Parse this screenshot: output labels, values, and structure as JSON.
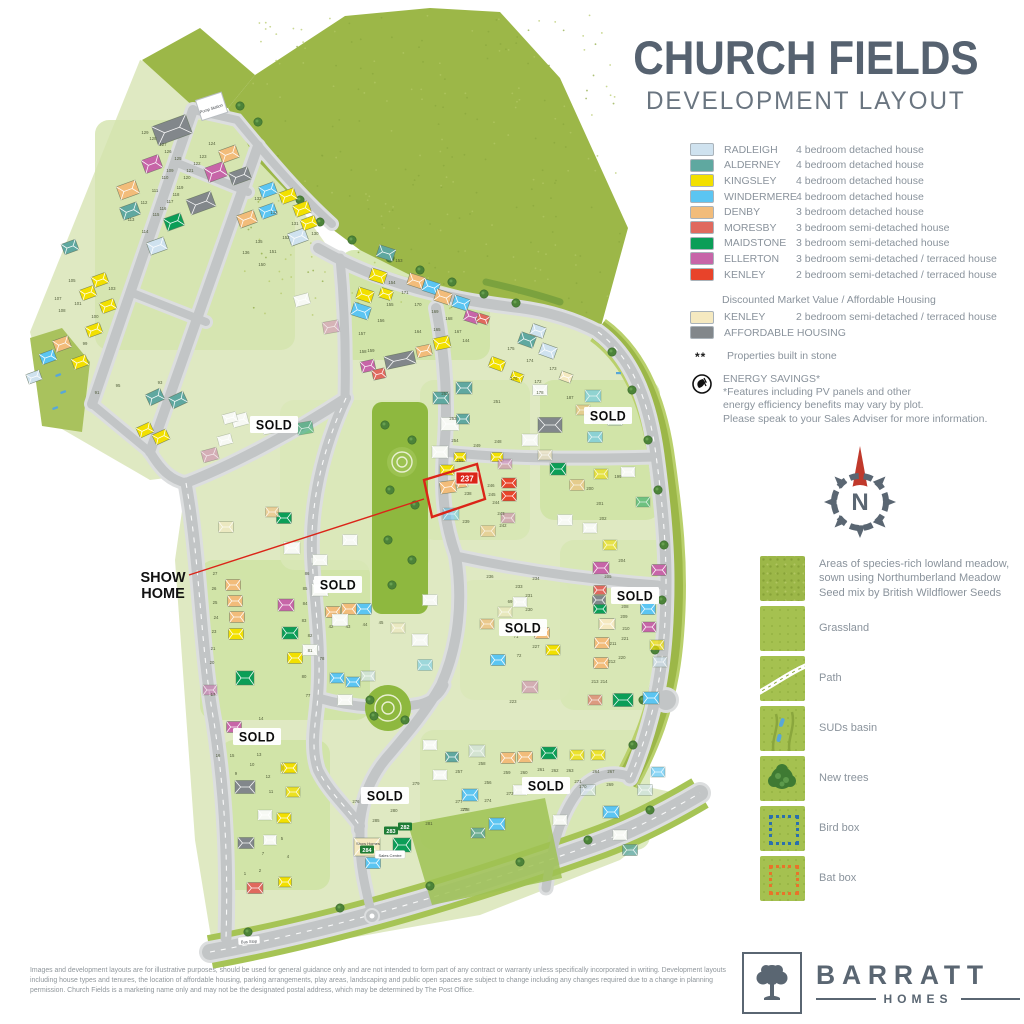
{
  "title": "CHURCH FIELDS",
  "subtitle": "DEVELOPMENT LAYOUT",
  "colors": {
    "rad": "#cfe2ef",
    "ald": "#5fa8a0",
    "kin": "#f2e000",
    "win": "#5bc5f2",
    "den": "#f2bc7a",
    "mor": "#e0695e",
    "mai": "#0b9e57",
    "ell": "#c765a8",
    "ken": "#e8432a",
    "dmv": "#f5e9c0",
    "aff": "#82878b",
    "wsh": "#f7f9f4",
    "red_accent": "#db2418",
    "title_gray": "#566270",
    "meadow": "#9cb748",
    "grass": "#a5c150",
    "site": "#dfe9c2",
    "road": "#c2c5c6"
  },
  "legend": {
    "house_types": [
      {
        "name": "RADLEIGH",
        "desc": "4 bedroom detached house",
        "color": "#cfe2ef"
      },
      {
        "name": "ALDERNEY",
        "desc": "4 bedroom detached house",
        "color": "#5fa8a0"
      },
      {
        "name": "KINGSLEY",
        "desc": "4 bedroom detached house",
        "color": "#f2e000"
      },
      {
        "name": "WINDERMERE",
        "desc": "4 bedroom detached house",
        "color": "#5bc5f2"
      },
      {
        "name": "DENBY",
        "desc": "3 bedroom detached house",
        "color": "#f2bc7a"
      },
      {
        "name": "MORESBY",
        "desc": "3 bedroom semi-detached house",
        "color": "#e0695e"
      },
      {
        "name": "MAIDSTONE",
        "desc": "3 bedroom semi-detached house",
        "color": "#0b9e57"
      },
      {
        "name": "ELLERTON",
        "desc": "3 bedroom semi-detached / terraced house",
        "color": "#c765a8"
      },
      {
        "name": "KENLEY",
        "desc": "2 bedroom semi-detached / terraced house",
        "color": "#e8432a"
      }
    ],
    "dmv_heading": "Discounted Market Value / Affordable Housing",
    "dmv_items": [
      {
        "name": "KENLEY",
        "desc": "2 bedroom semi-detached / terraced house",
        "color": "#f5e9c0"
      },
      {
        "name": "AFFORDABLE HOUSING",
        "desc": "",
        "color": "#82878b"
      }
    ],
    "stone_marker": "**",
    "stone_note": "Properties built in stone",
    "energy_title": "ENERGY SAVINGS*",
    "energy_note_1": "*Features including PV panels and other",
    "energy_note_2": "energy efficiency benefits may vary by plot.",
    "energy_note_3": "Please speak to your Sales Adviser for more information."
  },
  "features": [
    {
      "label": "Areas of species-rich lowland meadow, sown using Northumberland Meadow Seed mix by British Wildflower Seeds",
      "swatch": "meadow"
    },
    {
      "label": "Grassland",
      "swatch": "grassland"
    },
    {
      "label": "Path",
      "swatch": "path"
    },
    {
      "label": "SUDs basin",
      "swatch": "suds"
    },
    {
      "label": "New trees",
      "swatch": "trees"
    },
    {
      "label": "Bird box",
      "swatch": "birdbox"
    },
    {
      "label": "Bat box",
      "swatch": "batbox"
    }
  ],
  "compass": {
    "label": "N"
  },
  "map": {
    "sold_label": "SOLD",
    "sold_positions": [
      [
        274,
        425
      ],
      [
        608,
        416
      ],
      [
        338,
        585
      ],
      [
        635,
        596
      ],
      [
        523,
        628
      ],
      [
        257,
        737
      ],
      [
        385,
        796
      ],
      [
        546,
        786
      ]
    ],
    "show_home": {
      "line1": "SHOW",
      "line2": "HOME",
      "x": 163,
      "y": 578,
      "leader": [
        [
          189,
          575
        ],
        [
          424,
          499
        ]
      ],
      "outline": "424,480 477,464 485,499 432,517",
      "tag": {
        "text": "237",
        "x": 467,
        "y": 478
      }
    },
    "labels": [
      {
        "text": "Pump Station",
        "kind": "plain",
        "x": 211,
        "y": 108,
        "rot": -18
      },
      {
        "text": "Bus Stop",
        "kind": "pill",
        "x": 249,
        "y": 941,
        "rot": -4
      },
      {
        "text": "Show Homes",
        "kind": "plain",
        "x": 368,
        "y": 843,
        "rot": 0
      },
      {
        "text": "Sales Centre",
        "kind": "pill",
        "x": 390,
        "y": 855,
        "rot": 0
      },
      {
        "text": "282",
        "kind": "green",
        "x": 405,
        "y": 827,
        "rot": 0
      },
      {
        "text": "283",
        "kind": "green",
        "x": 391,
        "y": 831,
        "rot": 0
      },
      {
        "text": "284",
        "kind": "green",
        "x": 367,
        "y": 850,
        "rot": 0
      }
    ],
    "plot_numbers": [
      {
        "n": "129",
        "x": 145,
        "y": 134
      },
      {
        "n": "128",
        "x": 153,
        "y": 140
      },
      {
        "n": "127",
        "x": 163,
        "y": 146
      },
      {
        "n": "126",
        "x": 168,
        "y": 153
      },
      {
        "n": "125",
        "x": 178,
        "y": 160
      },
      {
        "n": "124",
        "x": 212,
        "y": 145
      },
      {
        "n": "123",
        "x": 203,
        "y": 158
      },
      {
        "n": "122",
        "x": 197,
        "y": 165
      },
      {
        "n": "121",
        "x": 190,
        "y": 172
      },
      {
        "n": "120",
        "x": 187,
        "y": 179
      },
      {
        "n": "109",
        "x": 170,
        "y": 172
      },
      {
        "n": "110",
        "x": 165,
        "y": 179
      },
      {
        "n": "111",
        "x": 155,
        "y": 192
      },
      {
        "n": "112",
        "x": 144,
        "y": 204
      },
      {
        "n": "113",
        "x": 131,
        "y": 221
      },
      {
        "n": "114",
        "x": 145,
        "y": 233
      },
      {
        "n": "115",
        "x": 156,
        "y": 216
      },
      {
        "n": "116",
        "x": 163,
        "y": 210
      },
      {
        "n": "117",
        "x": 170,
        "y": 203
      },
      {
        "n": "118",
        "x": 176,
        "y": 196
      },
      {
        "n": "119",
        "x": 180,
        "y": 189
      },
      {
        "n": "133",
        "x": 258,
        "y": 200
      },
      {
        "n": "132",
        "x": 274,
        "y": 214
      },
      {
        "n": "131",
        "x": 295,
        "y": 225
      },
      {
        "n": "130",
        "x": 315,
        "y": 235
      },
      {
        "n": "152",
        "x": 286,
        "y": 239
      },
      {
        "n": "135",
        "x": 259,
        "y": 243
      },
      {
        "n": "136",
        "x": 246,
        "y": 254
      },
      {
        "n": "151",
        "x": 273,
        "y": 253
      },
      {
        "n": "150",
        "x": 262,
        "y": 266
      },
      {
        "n": "93",
        "x": 160,
        "y": 384
      },
      {
        "n": "95",
        "x": 118,
        "y": 387
      },
      {
        "n": "91",
        "x": 97,
        "y": 394
      },
      {
        "n": "99",
        "x": 85,
        "y": 345
      },
      {
        "n": "100",
        "x": 95,
        "y": 318
      },
      {
        "n": "103",
        "x": 112,
        "y": 290
      },
      {
        "n": "105",
        "x": 72,
        "y": 282
      },
      {
        "n": "107",
        "x": 58,
        "y": 300
      },
      {
        "n": "108",
        "x": 62,
        "y": 312
      },
      {
        "n": "101",
        "x": 78,
        "y": 305
      },
      {
        "n": "153",
        "x": 399,
        "y": 262
      },
      {
        "n": "154",
        "x": 392,
        "y": 284
      },
      {
        "n": "171",
        "x": 405,
        "y": 294
      },
      {
        "n": "155",
        "x": 390,
        "y": 306
      },
      {
        "n": "170",
        "x": 418,
        "y": 306
      },
      {
        "n": "169",
        "x": 435,
        "y": 313
      },
      {
        "n": "156",
        "x": 381,
        "y": 322
      },
      {
        "n": "168",
        "x": 449,
        "y": 320
      },
      {
        "n": "157",
        "x": 362,
        "y": 335
      },
      {
        "n": "164",
        "x": 418,
        "y": 333
      },
      {
        "n": "165",
        "x": 437,
        "y": 331
      },
      {
        "n": "167",
        "x": 458,
        "y": 333
      },
      {
        "n": "158",
        "x": 363,
        "y": 353
      },
      {
        "n": "159",
        "x": 371,
        "y": 352
      },
      {
        "n": "144",
        "x": 466,
        "y": 342
      },
      {
        "n": "175",
        "x": 511,
        "y": 350
      },
      {
        "n": "174",
        "x": 530,
        "y": 362
      },
      {
        "n": "173",
        "x": 553,
        "y": 370
      },
      {
        "n": "176",
        "x": 514,
        "y": 380
      },
      {
        "n": "172",
        "x": 538,
        "y": 383
      },
      {
        "n": "178",
        "x": 540,
        "y": 394
      },
      {
        "n": "187",
        "x": 570,
        "y": 399
      },
      {
        "n": "185",
        "x": 596,
        "y": 424
      },
      {
        "n": "252",
        "x": 445,
        "y": 395
      },
      {
        "n": "251",
        "x": 497,
        "y": 403
      },
      {
        "n": "253",
        "x": 453,
        "y": 420
      },
      {
        "n": "254",
        "x": 455,
        "y": 442
      },
      {
        "n": "255",
        "x": 460,
        "y": 462
      },
      {
        "n": "249",
        "x": 477,
        "y": 447
      },
      {
        "n": "248",
        "x": 498,
        "y": 443
      },
      {
        "n": "246",
        "x": 491,
        "y": 487
      },
      {
        "n": "245",
        "x": 492,
        "y": 496
      },
      {
        "n": "244",
        "x": 496,
        "y": 504
      },
      {
        "n": "238",
        "x": 468,
        "y": 495
      },
      {
        "n": "243",
        "x": 501,
        "y": 515
      },
      {
        "n": "242",
        "x": 503,
        "y": 527
      },
      {
        "n": "239",
        "x": 466,
        "y": 523
      },
      {
        "n": "199",
        "x": 618,
        "y": 478
      },
      {
        "n": "200",
        "x": 590,
        "y": 490
      },
      {
        "n": "201",
        "x": 600,
        "y": 505
      },
      {
        "n": "202",
        "x": 603,
        "y": 520
      },
      {
        "n": "204",
        "x": 622,
        "y": 562
      },
      {
        "n": "205",
        "x": 608,
        "y": 578
      },
      {
        "n": "208",
        "x": 625,
        "y": 608
      },
      {
        "n": "209",
        "x": 624,
        "y": 618
      },
      {
        "n": "210",
        "x": 626,
        "y": 630
      },
      {
        "n": "211",
        "x": 613,
        "y": 645
      },
      {
        "n": "212",
        "x": 612,
        "y": 663
      },
      {
        "n": "213",
        "x": 595,
        "y": 683
      },
      {
        "n": "214",
        "x": 604,
        "y": 683
      },
      {
        "n": "220",
        "x": 622,
        "y": 659
      },
      {
        "n": "221",
        "x": 625,
        "y": 640
      },
      {
        "n": "231",
        "x": 529,
        "y": 597
      },
      {
        "n": "230",
        "x": 529,
        "y": 611
      },
      {
        "n": "227",
        "x": 536,
        "y": 648
      },
      {
        "n": "223",
        "x": 513,
        "y": 703
      },
      {
        "n": "69",
        "x": 510,
        "y": 603
      },
      {
        "n": "71",
        "x": 516,
        "y": 638
      },
      {
        "n": "72",
        "x": 519,
        "y": 657
      },
      {
        "n": "233",
        "x": 519,
        "y": 588
      },
      {
        "n": "234",
        "x": 536,
        "y": 580
      },
      {
        "n": "236",
        "x": 490,
        "y": 578
      },
      {
        "n": "42",
        "x": 331,
        "y": 628
      },
      {
        "n": "43",
        "x": 348,
        "y": 628
      },
      {
        "n": "44",
        "x": 365,
        "y": 626
      },
      {
        "n": "45",
        "x": 381,
        "y": 624
      },
      {
        "n": "86",
        "x": 307,
        "y": 575
      },
      {
        "n": "85",
        "x": 305,
        "y": 590
      },
      {
        "n": "84",
        "x": 305,
        "y": 605
      },
      {
        "n": "83",
        "x": 304,
        "y": 622
      },
      {
        "n": "82",
        "x": 310,
        "y": 637
      },
      {
        "n": "81",
        "x": 310,
        "y": 652
      },
      {
        "n": "78",
        "x": 322,
        "y": 660
      },
      {
        "n": "80",
        "x": 304,
        "y": 678
      },
      {
        "n": "77",
        "x": 308,
        "y": 697
      },
      {
        "n": "27",
        "x": 215,
        "y": 575
      },
      {
        "n": "26",
        "x": 214,
        "y": 590
      },
      {
        "n": "25",
        "x": 215,
        "y": 604
      },
      {
        "n": "24",
        "x": 216,
        "y": 619
      },
      {
        "n": "23",
        "x": 214,
        "y": 633
      },
      {
        "n": "21",
        "x": 213,
        "y": 650
      },
      {
        "n": "20",
        "x": 212,
        "y": 664
      },
      {
        "n": "17",
        "x": 213,
        "y": 696
      },
      {
        "n": "14",
        "x": 261,
        "y": 720
      },
      {
        "n": "16",
        "x": 218,
        "y": 757
      },
      {
        "n": "15",
        "x": 232,
        "y": 757
      },
      {
        "n": "13",
        "x": 259,
        "y": 756
      },
      {
        "n": "12",
        "x": 268,
        "y": 778
      },
      {
        "n": "10",
        "x": 252,
        "y": 766
      },
      {
        "n": "11",
        "x": 271,
        "y": 793
      },
      {
        "n": "9",
        "x": 236,
        "y": 775
      },
      {
        "n": "7",
        "x": 263,
        "y": 855
      },
      {
        "n": "5",
        "x": 282,
        "y": 840
      },
      {
        "n": "4",
        "x": 288,
        "y": 858
      },
      {
        "n": "2",
        "x": 260,
        "y": 872
      },
      {
        "n": "1",
        "x": 245,
        "y": 875
      },
      {
        "n": "257",
        "x": 459,
        "y": 773
      },
      {
        "n": "258",
        "x": 482,
        "y": 765
      },
      {
        "n": "259",
        "x": 507,
        "y": 774
      },
      {
        "n": "260",
        "x": 524,
        "y": 774
      },
      {
        "n": "261",
        "x": 541,
        "y": 771
      },
      {
        "n": "262",
        "x": 555,
        "y": 772
      },
      {
        "n": "263",
        "x": 570,
        "y": 772
      },
      {
        "n": "264",
        "x": 596,
        "y": 773
      },
      {
        "n": "267",
        "x": 611,
        "y": 773
      },
      {
        "n": "256",
        "x": 488,
        "y": 784
      },
      {
        "n": "273",
        "x": 510,
        "y": 795
      },
      {
        "n": "274",
        "x": 488,
        "y": 802
      },
      {
        "n": "275",
        "x": 464,
        "y": 811
      },
      {
        "n": "271",
        "x": 578,
        "y": 783
      },
      {
        "n": "270",
        "x": 583,
        "y": 788
      },
      {
        "n": "269",
        "x": 610,
        "y": 786
      },
      {
        "n": "281",
        "x": 429,
        "y": 825
      },
      {
        "n": "276",
        "x": 356,
        "y": 803
      },
      {
        "n": "279",
        "x": 416,
        "y": 785
      },
      {
        "n": "280",
        "x": 394,
        "y": 812
      },
      {
        "n": "285",
        "x": 376,
        "y": 822
      },
      {
        "n": "277",
        "x": 459,
        "y": 803
      },
      {
        "n": "278",
        "x": 466,
        "y": 811
      }
    ]
  },
  "brand": {
    "name": "BARRATT",
    "sub": "HOMES"
  },
  "footer": {
    "disclaimer": "Images and development layouts are for illustrative purposes, should be used for general guidance only and are not intended to form part of any contract or warranty unless specifically incorporated in writing. Development layouts including house types and tenures, the location of affordable housing, parking arrangements, play areas, landscaping and public open spaces are subject to change including any changes required due to a change in planning permission. Church Fields is a marketing name only and may not be the designated postal address, which may be determined by The Post Office."
  }
}
